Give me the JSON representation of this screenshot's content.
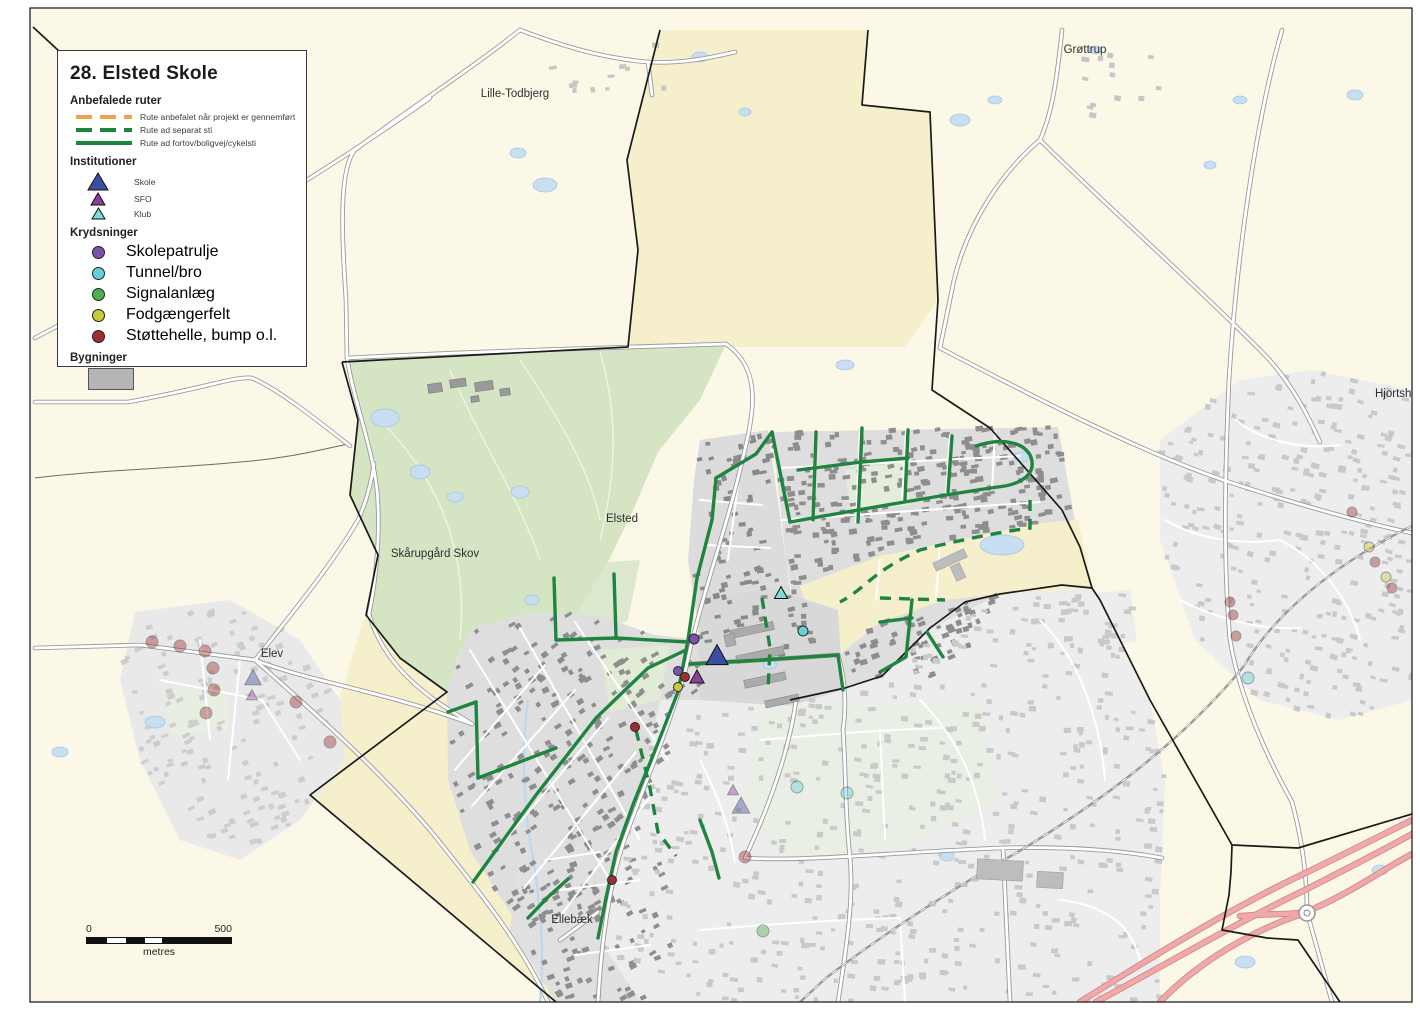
{
  "legend": {
    "title": "28. Elsted Skole",
    "routes": {
      "header": "Anbefalede ruter",
      "items": [
        {
          "label": "Rute anbefalet når projekt er gennemført",
          "style": "dashed",
          "color": "#F0A34F"
        },
        {
          "label": "Rute ad separat sti",
          "style": "dashed",
          "color": "#1F8440"
        },
        {
          "label": "Rute ad fortov/boligvej/cykelsti",
          "style": "solid",
          "color": "#1F8440"
        }
      ]
    },
    "institutions": {
      "header": "Institutioner",
      "items": [
        {
          "label": "Skole",
          "type": "skole",
          "size": 18
        },
        {
          "label": "SFO",
          "type": "sfo",
          "size": 13
        },
        {
          "label": "Klub",
          "type": "klub",
          "size": 12
        }
      ]
    },
    "crossings": {
      "header": "Krydsninger",
      "items": [
        {
          "label": "Skolepatrulje",
          "type": "skolepatrulje"
        },
        {
          "label": "Tunnel/bro",
          "type": "tunnelbro"
        },
        {
          "label": "Signalanlæg",
          "type": "signalanlaeg"
        },
        {
          "label": "Fodgængerfelt",
          "type": "fodgaengerfelt"
        },
        {
          "label": "Støttehelle, bump o.l.",
          "type": "stottehelle"
        }
      ]
    },
    "buildings": {
      "header": "Bygninger",
      "swatch": "#B5B5B5"
    }
  },
  "scalebar": {
    "start": "0",
    "end": "500",
    "unit": "metres"
  },
  "map": {
    "labels": [
      {
        "text": "Lille-Todbjerg",
        "x": 515,
        "y": 97
      },
      {
        "text": "Grøttrup",
        "x": 1085,
        "y": 53
      },
      {
        "text": "Hjortshøj",
        "x": 1398,
        "y": 397
      },
      {
        "text": "Elsted",
        "x": 622,
        "y": 522
      },
      {
        "text": "Skårupgård Skov",
        "x": 435,
        "y": 557
      },
      {
        "text": "Elev",
        "x": 272,
        "y": 657
      },
      {
        "text": "Ellebæk",
        "x": 572,
        "y": 923
      }
    ],
    "markers": {
      "triangles": [
        {
          "type": "skole",
          "x": 717,
          "y": 657,
          "size": 20,
          "faded": false
        },
        {
          "type": "sfo",
          "x": 697,
          "y": 678,
          "size": 13,
          "faded": false
        },
        {
          "type": "klub",
          "x": 781,
          "y": 594,
          "size": 12,
          "faded": false
        },
        {
          "type": "skole",
          "x": 253,
          "y": 679,
          "size": 15,
          "faded": true
        },
        {
          "type": "sfo",
          "x": 252,
          "y": 696,
          "size": 10,
          "faded": true
        },
        {
          "type": "sfo",
          "x": 733,
          "y": 791,
          "size": 10,
          "faded": true
        },
        {
          "type": "skole",
          "x": 741,
          "y": 807,
          "size": 16,
          "faded": true
        }
      ],
      "circles": [
        {
          "type": "skolepatrulje",
          "x": 694,
          "y": 639,
          "r": 5,
          "faded": false
        },
        {
          "type": "skolepatrulje",
          "x": 678,
          "y": 671,
          "r": 4.5,
          "faded": false
        },
        {
          "type": "stottehelle",
          "x": 685,
          "y": 677,
          "r": 4.5,
          "faded": false
        },
        {
          "type": "fodgaengerfelt",
          "x": 678,
          "y": 687,
          "r": 4.5,
          "faded": false
        },
        {
          "type": "tunnelbro",
          "x": 803,
          "y": 631,
          "r": 5,
          "faded": false
        },
        {
          "type": "stottehelle",
          "x": 635,
          "y": 727,
          "r": 4.5,
          "faded": false
        },
        {
          "type": "stottehelle",
          "x": 612,
          "y": 880,
          "r": 4.5,
          "faded": false
        },
        {
          "type": "tunnelbro",
          "x": 797,
          "y": 787,
          "r": 6,
          "faded": true
        },
        {
          "type": "tunnelbro",
          "x": 847,
          "y": 793,
          "r": 6,
          "faded": true
        },
        {
          "type": "stottehelle",
          "x": 745,
          "y": 857,
          "r": 6,
          "faded": true
        },
        {
          "type": "signalanlaeg",
          "x": 763,
          "y": 931,
          "r": 6,
          "faded": true
        },
        {
          "type": "tunnelbro",
          "x": 1248,
          "y": 678,
          "r": 6,
          "faded": true
        },
        {
          "type": "stottehelle",
          "x": 1230,
          "y": 602,
          "r": 5,
          "faded": true
        },
        {
          "type": "stottehelle",
          "x": 1233,
          "y": 615,
          "r": 5,
          "faded": true
        },
        {
          "type": "stottehelle",
          "x": 1236,
          "y": 636,
          "r": 5,
          "faded": true
        },
        {
          "type": "fodgaengerfelt",
          "x": 1369,
          "y": 547,
          "r": 5,
          "faded": true
        },
        {
          "type": "stottehelle",
          "x": 1375,
          "y": 562,
          "r": 5,
          "faded": true
        },
        {
          "type": "fodgaengerfelt",
          "x": 1386,
          "y": 577,
          "r": 5,
          "faded": true
        },
        {
          "type": "stottehelle",
          "x": 1392,
          "y": 588,
          "r": 5,
          "faded": true
        },
        {
          "type": "stottehelle",
          "x": 1352,
          "y": 512,
          "r": 5,
          "faded": true
        },
        {
          "type": "stottehelle",
          "x": 152,
          "y": 642,
          "r": 6,
          "faded": true
        },
        {
          "type": "stottehelle",
          "x": 180,
          "y": 646,
          "r": 6,
          "faded": true
        },
        {
          "type": "stottehelle",
          "x": 205,
          "y": 651,
          "r": 6,
          "faded": true
        },
        {
          "type": "stottehelle",
          "x": 213,
          "y": 668,
          "r": 6,
          "faded": true
        },
        {
          "type": "stottehelle",
          "x": 214,
          "y": 690,
          "r": 6,
          "faded": true
        },
        {
          "type": "stottehelle",
          "x": 206,
          "y": 713,
          "r": 6,
          "faded": true
        },
        {
          "type": "stottehelle",
          "x": 296,
          "y": 702,
          "r": 6,
          "faded": true
        },
        {
          "type": "stottehelle",
          "x": 330,
          "y": 742,
          "r": 6,
          "faded": true
        }
      ]
    }
  },
  "colors": {
    "base": "#FBF8E8",
    "district_yellow": "#F6EFCC",
    "forest": "#D5E4C3",
    "route_green": "#1F8440",
    "route_orange": "#F0A34F",
    "water": "#C8DFF2",
    "motorway": "#F0A8A8",
    "markers": {
      "skole": "#3B4FA2",
      "sfo": "#8B3E9B",
      "klub": "#7FD8DE",
      "skolepatrulje": "#7B52A8",
      "tunnelbro": "#63CEDC",
      "signalanlaeg": "#4CB04C",
      "fodgaengerfelt": "#C9C93B",
      "stottehelle": "#9E2F2F"
    }
  }
}
